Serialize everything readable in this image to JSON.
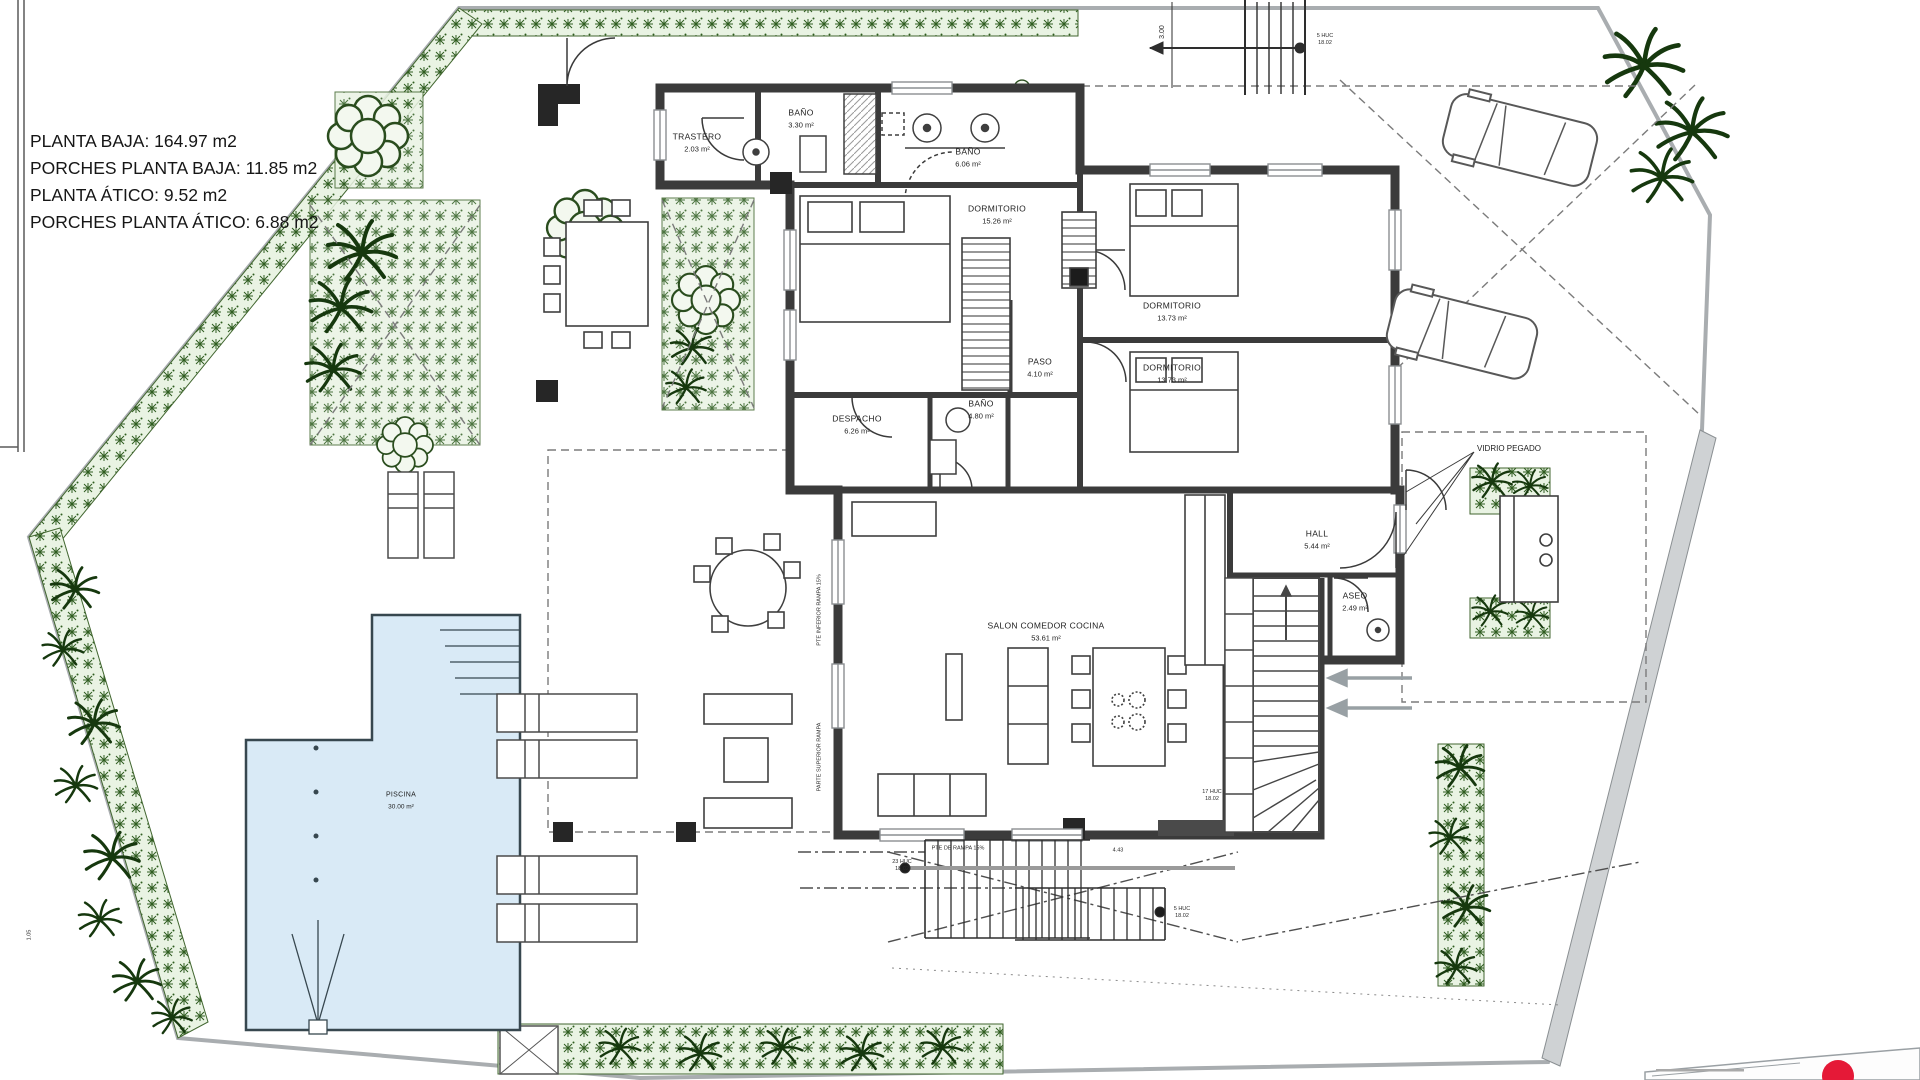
{
  "summary": {
    "lines": [
      "PLANTA BAJA: 164.97 m2",
      "PORCHES PLANTA BAJA: 11.85 m2",
      "PLANTA ÁTICO: 9.52 m2",
      "PORCHES PLANTA ÁTICO: 6.88 m2"
    ]
  },
  "rooms": {
    "trastero": {
      "name": "TRASTERO",
      "area": "2.03 m²"
    },
    "bano_top": {
      "name": "BAÑO",
      "area": "3.30 m²"
    },
    "bano_suite": {
      "name": "BAÑO",
      "area": "6.06 m²"
    },
    "dorm_ppal": {
      "name": "DORMITORIO",
      "area": "15.26 m²"
    },
    "dorm_2": {
      "name": "DORMITORIO",
      "area": "13.73 m²"
    },
    "dorm_3": {
      "name": "DORMITORIO",
      "area": "13.73 m²"
    },
    "paso": {
      "name": "PASO",
      "area": "4.10 m²"
    },
    "bano_pas": {
      "name": "BAÑO",
      "area": "4.80 m²"
    },
    "despacho": {
      "name": "DESPACHO",
      "area": "6.26 m²"
    },
    "hall": {
      "name": "HALL",
      "area": "5.44 m²"
    },
    "aseo": {
      "name": "ASEO",
      "area": "2.49 m²"
    },
    "salon": {
      "name": "SALON COMEDOR COCINA",
      "area": "53.61 m²"
    },
    "piscina": {
      "name": "PISCINA",
      "area": "30.00 m²"
    }
  },
  "annotations": {
    "vidrio": "VIDRIO PEGADO",
    "dim_vertical": "3.00",
    "stair_top_a": "5 HUC",
    "stair_top_b": "18.02",
    "stair_int_a": "17 HUC",
    "stair_int_b": "18.02",
    "ramp": "PTE DE RAMPA 15%",
    "stair_bot_a": "23 HUC",
    "stair_bot_b": "18.02",
    "dim_bottom": "4.43",
    "stair_bot2_a": "5 HUC",
    "stair_bot2_b": "18.02",
    "ramp_v1": "PTE INFERIOR RAMPA 15%",
    "ramp_v2": "PARTE SUPERIOR RAMPA",
    "dim_left": "1.05"
  },
  "colors": {
    "wall": "#3b3b3b",
    "boundary": "#a9adb0",
    "hedge_green": "#2f5d20",
    "pool_fill": "#d9eaf6",
    "logo_red": "#e51937"
  }
}
